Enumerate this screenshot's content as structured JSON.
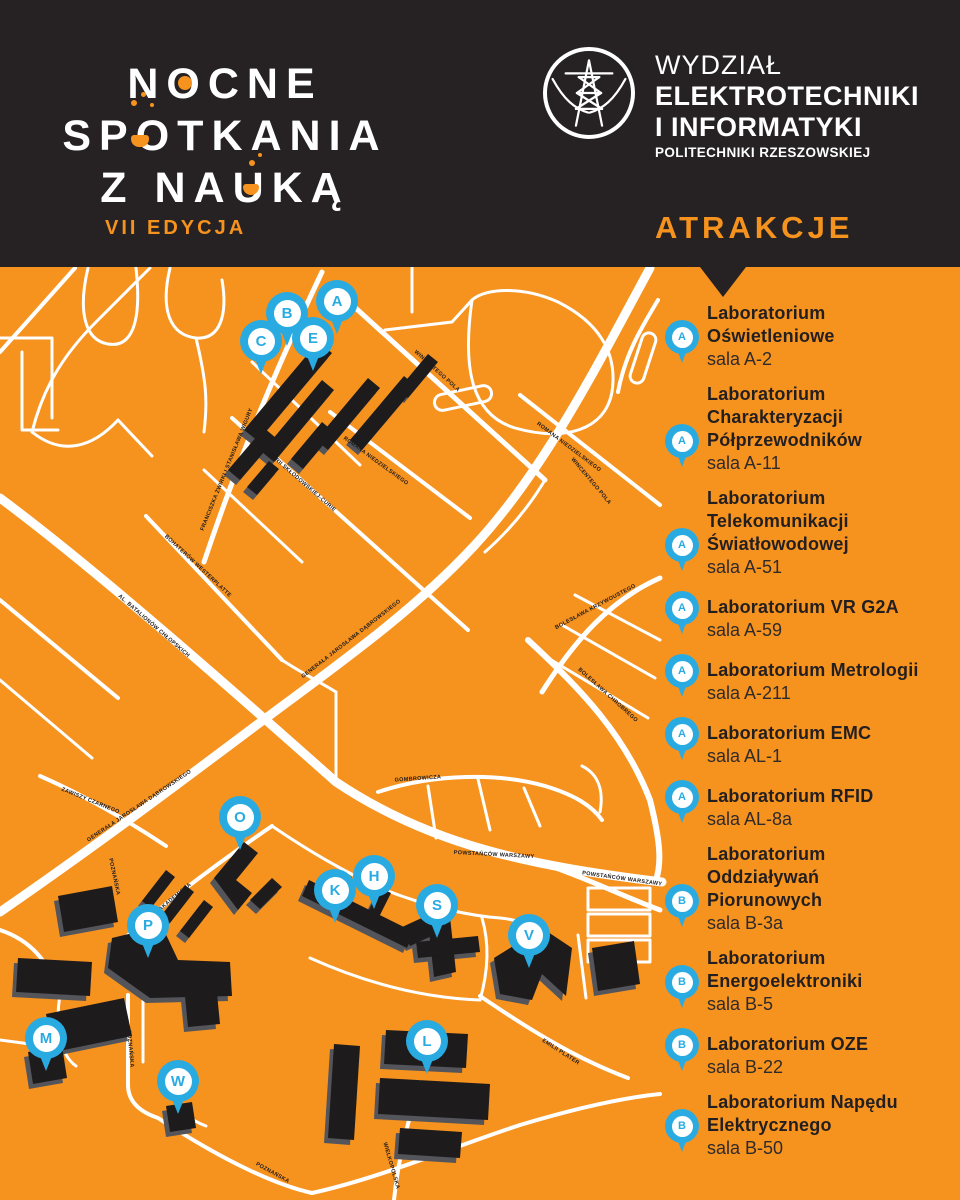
{
  "header": {
    "event_logo": {
      "line1": "NOCNE",
      "line2": "SPOTKANIA",
      "line3": "Z NAUKĄ",
      "edition": "VII EDYCJA"
    },
    "faculty_logo": {
      "line1": "WYDZIAŁ",
      "line2": "ELEKTROTECHNIKI",
      "line3": "I INFORMATYKI",
      "line4": "POLITECHNIKI RZESZOWSKIEJ"
    },
    "attractions_heading": "ATRAKCJE"
  },
  "colors": {
    "orange": "#F6921E",
    "dark": "#262223",
    "blue": "#29ABE2",
    "building": "#1D1B1C",
    "building_side": "#54555B",
    "street": "#FFFFFF"
  },
  "attractions": [
    {
      "letter": "A",
      "name": "Laboratorium Oświetleniowe",
      "room": "sala A-2"
    },
    {
      "letter": "A",
      "name": "Laboratorium Charakteryzacji Półprzewodników",
      "room": "sala A-11"
    },
    {
      "letter": "A",
      "name": "Laboratorium Telekomunikacji Światłowodowej",
      "room": "sala A-51"
    },
    {
      "letter": "A",
      "name": "Laboratorium VR G2A",
      "room": "sala A-59"
    },
    {
      "letter": "A",
      "name": "Laboratorium Metrologii",
      "room": "sala A-211"
    },
    {
      "letter": "A",
      "name": "Laboratorium EMC",
      "room": "sala AL-1"
    },
    {
      "letter": "A",
      "name": "Laboratorium RFID",
      "room": "sala AL-8a"
    },
    {
      "letter": "B",
      "name": "Laboratorium Oddziaływań Piorunowych",
      "room": "sala B-3a"
    },
    {
      "letter": "B",
      "name": "Laboratorium Energoelektroniki",
      "room": "sala B-5"
    },
    {
      "letter": "B",
      "name": "Laboratorium OZE",
      "room": "sala B-22"
    },
    {
      "letter": "B",
      "name": "Laboratorium Napędu Elektrycznego",
      "room": "sala B-50"
    }
  ],
  "map": {
    "markers": [
      {
        "letter": "A",
        "x": 337,
        "y": 301
      },
      {
        "letter": "B",
        "x": 287,
        "y": 313
      },
      {
        "letter": "C",
        "x": 261,
        "y": 341
      },
      {
        "letter": "E",
        "x": 313,
        "y": 338
      },
      {
        "letter": "O",
        "x": 240,
        "y": 817
      },
      {
        "letter": "P",
        "x": 148,
        "y": 925
      },
      {
        "letter": "K",
        "x": 335,
        "y": 890
      },
      {
        "letter": "H",
        "x": 374,
        "y": 876
      },
      {
        "letter": "S",
        "x": 437,
        "y": 905
      },
      {
        "letter": "V",
        "x": 529,
        "y": 935
      },
      {
        "letter": "M",
        "x": 46,
        "y": 1038
      },
      {
        "letter": "W",
        "x": 178,
        "y": 1081
      },
      {
        "letter": "L",
        "x": 427,
        "y": 1041
      }
    ],
    "street_labels": [
      {
        "text": "FRANCISZKA ŻWIRKI I STANISŁAWA WIGURY",
        "x": 228,
        "y": 470,
        "rot": -68
      },
      {
        "text": "MARII SKŁODOWSKIEJ-CURIE",
        "x": 301,
        "y": 483,
        "rot": 41
      },
      {
        "text": "ROMANA NIEDZIELSKIEGO",
        "x": 375,
        "y": 462,
        "rot": 36
      },
      {
        "text": "ROMANA NIEDZIELSKIEGO",
        "x": 568,
        "y": 448,
        "rot": 37
      },
      {
        "text": "BOHATERÓW WESTERPLATTE",
        "x": 197,
        "y": 567,
        "rot": 43
      },
      {
        "text": "WINCENTEGO POLA",
        "x": 436,
        "y": 372,
        "rot": 42
      },
      {
        "text": "WINCENTEGO POLA",
        "x": 590,
        "y": 482,
        "rot": 50
      },
      {
        "text": "AL. BATALIONÓW CHŁOPSKICH",
        "x": 153,
        "y": 627,
        "rot": 41
      },
      {
        "text": "GENERAŁA JAROSŁAWA DĄBROWSKIEGO",
        "x": 352,
        "y": 640,
        "rot": -38
      },
      {
        "text": "GENERAŁA JAROSŁAWA DĄBROWSKIEGO",
        "x": 140,
        "y": 807,
        "rot": -34
      },
      {
        "text": "ZAWISZY CZARNEGO",
        "x": 90,
        "y": 802,
        "rot": 22
      },
      {
        "text": "BOLESŁAWA KRZYWOUSTEGO",
        "x": 596,
        "y": 608,
        "rot": -28
      },
      {
        "text": "BOLESŁAWA CHROBREGO",
        "x": 607,
        "y": 696,
        "rot": 42
      },
      {
        "text": "GOMBROWICZA",
        "x": 418,
        "y": 780,
        "rot": -4
      },
      {
        "text": "POWSTAŃCÓW WARSZAWY",
        "x": 494,
        "y": 856,
        "rot": 3
      },
      {
        "text": "POWSTAŃCÓW WARSZAWY",
        "x": 622,
        "y": 880,
        "rot": 8
      },
      {
        "text": "AKADEMICKA",
        "x": 176,
        "y": 898,
        "rot": -40
      },
      {
        "text": "POZNAŃSKA",
        "x": 113,
        "y": 877,
        "rot": 78
      },
      {
        "text": "POZNAŃSKA",
        "x": 129,
        "y": 1049,
        "rot": 85
      },
      {
        "text": "POZNAŃSKA",
        "x": 272,
        "y": 1174,
        "rot": 29
      },
      {
        "text": "WIELKOPOLSKA",
        "x": 390,
        "y": 1166,
        "rot": 74
      },
      {
        "text": "EMILII PLATER",
        "x": 560,
        "y": 1053,
        "rot": 33
      }
    ]
  }
}
